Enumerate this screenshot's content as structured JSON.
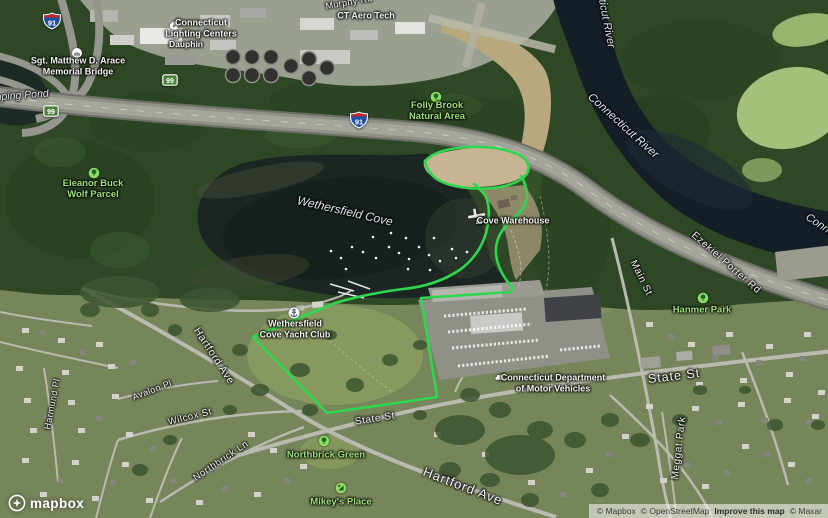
{
  "labels": {
    "murphy_rd": "Murphy Rd",
    "ct_lighting_1": "Connecticut",
    "ct_lighting_2": "Lighting Centers",
    "dauphin": "Dauphin",
    "bridge_1": "Sgt. Matthew D. Arace",
    "bridge_2": "Memorial Bridge",
    "camping_pond": "Camping Pond",
    "ct_aero_tech": "CT Aero Tech",
    "folly_brook_1": "Folly Brook",
    "folly_brook_2": "Natural Area",
    "connecticut_river": "Connecticut River",
    "eleanor_1": "Eleanor Buck",
    "eleanor_2": "Wolf Parcel",
    "wethersfield_cove": "Wethersfield Cove",
    "cove_warehouse": "Cove Warehouse",
    "ezekiel_porter_rd": "Ezekiel Porter Rd",
    "main_st": "Main St",
    "hanmer_park": "Hanmer Park",
    "yacht_club_1": "Wethersfield",
    "yacht_club_2": "Cove Yacht Club",
    "hartford_ave": "Hartford Ave",
    "avalon_pl": "Avalon Pl",
    "harmund_pl": "Harmund Pl",
    "wilcox_st": "Wilcox St",
    "northbrick_ln": "Northbrick Ln",
    "northbrick_green": "Northbrick Green",
    "mikeys_place": "Mikey's Place",
    "state_st": "State St",
    "dmv_1": "Connecticut Department",
    "dmv_2": "of Motor Vehicles",
    "meggat_park": "Meggat Park"
  },
  "shields": {
    "interstate": "91",
    "state_route": "99"
  },
  "logo": {
    "text": "mapbox"
  },
  "attribution": {
    "mapbox": "© Mapbox",
    "osm": "© OpenStreetMap",
    "improve": "Improve this map",
    "maxar": "© Maxar"
  },
  "colors": {
    "boundary_green": "#2FD64F",
    "park_label_green": "#9DE077",
    "water_label": "#DDE6EE",
    "cove_water": "#1B2622",
    "river_water": "#141E27"
  }
}
